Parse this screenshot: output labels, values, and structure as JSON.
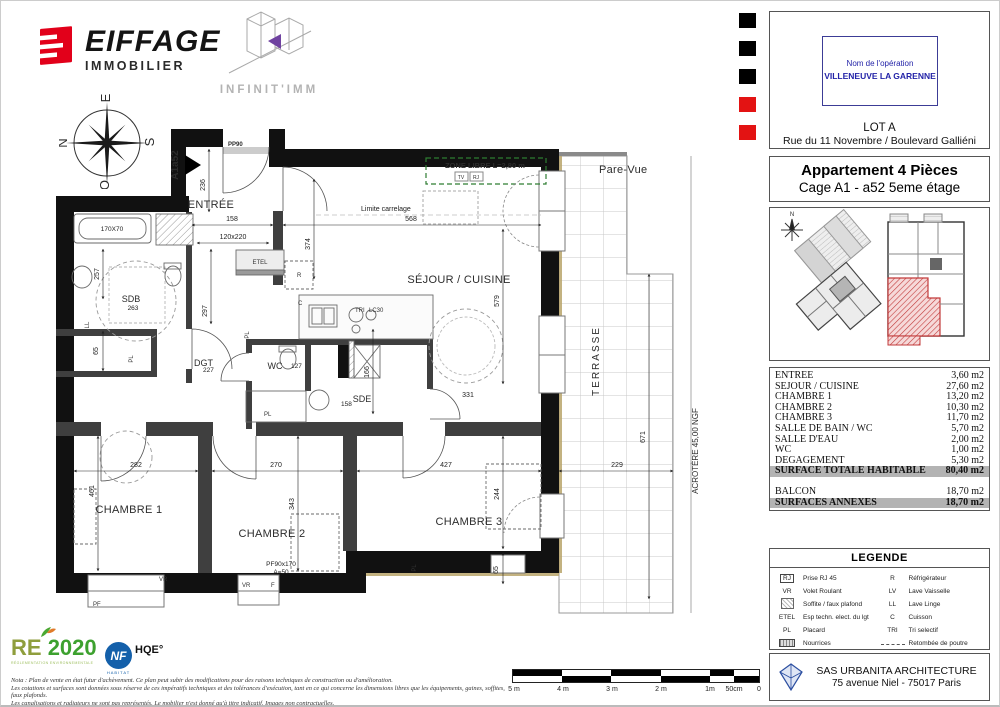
{
  "brand": {
    "eiffage": "EIFFAGE",
    "eiffage_sub": "IMMOBILIER",
    "infinitimm": "INFINIT'IMM"
  },
  "registration_marks": {
    "colors": [
      "#000000",
      "#000000",
      "#000000",
      "#e31313",
      "#e31313"
    ]
  },
  "info_panel": {
    "operation_label": "Nom de l'opération",
    "operation_name": "VILLENEUVE LA GARENNE",
    "lot": "LOT A",
    "address": "Rue du 11 Novembre / Boulevard Galliéni",
    "title": "Appartement 4 Pièces",
    "subtitle": "Cage A1 - a52  5eme étage",
    "mini_compass_n": "N"
  },
  "surface_table": {
    "rows": [
      {
        "label": "ENTREE",
        "value": "3,60 m2"
      },
      {
        "label": "SEJOUR / CUISINE",
        "value": "27,60 m2"
      },
      {
        "label": "CHAMBRE 1",
        "value": "13,20 m2"
      },
      {
        "label": "CHAMBRE 2",
        "value": "10,30 m2"
      },
      {
        "label": "CHAMBRE 3",
        "value": "11,70 m2"
      },
      {
        "label": "SALLE DE BAIN / WC",
        "value": "5,70 m2"
      },
      {
        "label": "SALLE D'EAU",
        "value": "2,00 m2"
      },
      {
        "label": "WC",
        "value": "1,00 m2"
      },
      {
        "label": "DEGAGEMENT",
        "value": "5,30 m2"
      }
    ],
    "total": {
      "label": "SURFACE TOTALE HABITABLE",
      "value": "80,40 m2"
    },
    "balcon": {
      "label": "BALCON",
      "value": "18,70 m2"
    },
    "annexes": {
      "label": "SURFACES ANNEXES",
      "value": "18,70 m2"
    }
  },
  "legend": {
    "title": "LEGENDE",
    "left": [
      {
        "code": "RJ",
        "label": "Prise RJ 45"
      },
      {
        "code": "VR",
        "label": "Volet Roulant"
      },
      {
        "code": "",
        "label": "Soffite / faux plafond"
      },
      {
        "code": "ETEL",
        "label": "Esp techn. elect. du lgt"
      },
      {
        "code": "PL",
        "label": "Placard"
      },
      {
        "code": "",
        "label": "Nourrices"
      }
    ],
    "right": [
      {
        "code": "R",
        "label": "Réfrigérateur"
      },
      {
        "code": "LV",
        "label": "Lave Vaisselle"
      },
      {
        "code": "LL",
        "label": "Lave Linge"
      },
      {
        "code": "C",
        "label": "Cuisson"
      },
      {
        "code": "TRI",
        "label": "Tri selectif"
      },
      {
        "code": "",
        "label": "Retombée de poutre"
      }
    ]
  },
  "revision": {
    "indice_label": "Indice :",
    "indice_value": "A",
    "status": "PLANS DE VENTE PROVISOIRES",
    "date": "MARS 2024",
    "accent": "#cc3366"
  },
  "architect": {
    "name": "SAS URBANITA ARCHITECTURE",
    "address": "75 avenue Niel - 75017 Paris"
  },
  "certifications": {
    "re": "RE",
    "re_year": "2020",
    "re_sub": "RÉGLEMENTATION ENVIRONNEMENTALE",
    "nf": "NF",
    "hqe": "HQE°",
    "habitat": "HABITAT"
  },
  "notes": [
    "Nota : Plan de vente en état futur d'achèvement. Ce plan peut subir des modifications pour des raisons techniques de construction ou d'amélioration.",
    "Les cotations et surfaces sont données sous réserve de ces impératifs techniques et des tolérances d'exécution, tant en ce qui concerne les dimensions libres que les équipements, gaines, soffites, faux plafonds.",
    "Les canalisations et radiateurs ne sont pas représentés. Le mobilier n'est donné qu'à titre indicatif. Images non contractuelles."
  ],
  "scale_bar": {
    "labels": [
      "5 m",
      "4 m",
      "3 m",
      "2 m",
      "1m",
      "50cm",
      "0"
    ]
  },
  "compass": {
    "n": "N",
    "e": "E",
    "s": "S",
    "o": "O"
  },
  "plan": {
    "unit": "A1a52",
    "door": "PP90",
    "zone_libre": "ZONE LIBRE L=2,80 m",
    "tv": "TV",
    "rj": "RJ",
    "pare_vue": "Pare-Vue",
    "terrasse": "TERRASSE",
    "acrotere": "ACROTÈRE 45,00 NGF",
    "limite_carrelage": "Limite carrelage",
    "rooms": {
      "entree": "ENTRÉE",
      "sdb": "SDB",
      "wc": "WC",
      "sde": "SDE",
      "dgt": "DGT",
      "sejour": "SÉJOUR / CUISINE",
      "ch1": "CHAMBRE 1",
      "ch2": "CHAMBRE 2",
      "ch3": "CHAMBRE 3"
    },
    "codes": {
      "etel": "ETEL",
      "pl": "PL",
      "ll": "LL",
      "vr": "VR",
      "pf": "PF",
      "f": "F",
      "r": "R",
      "c": "C",
      "tri": "TRI",
      "lc": "LC30"
    },
    "dims": {
      "d236": "236",
      "d158": "158",
      "d120": "120x220",
      "d568": "568",
      "d374": "374",
      "d579": "579",
      "d257": "257",
      "d263": "263",
      "d297": "297",
      "d65": "65",
      "d227": "227",
      "d127": "127",
      "d158b": "158",
      "d166": "166",
      "d170": "170X70",
      "d282": "282",
      "d461": "461",
      "d270": "270",
      "d343": "343",
      "d427": "427",
      "d244": "244",
      "d65b": "65",
      "d229": "229",
      "d671": "671",
      "d331": "331",
      "pf90": "PF90x170",
      "a50": "A=50"
    }
  }
}
